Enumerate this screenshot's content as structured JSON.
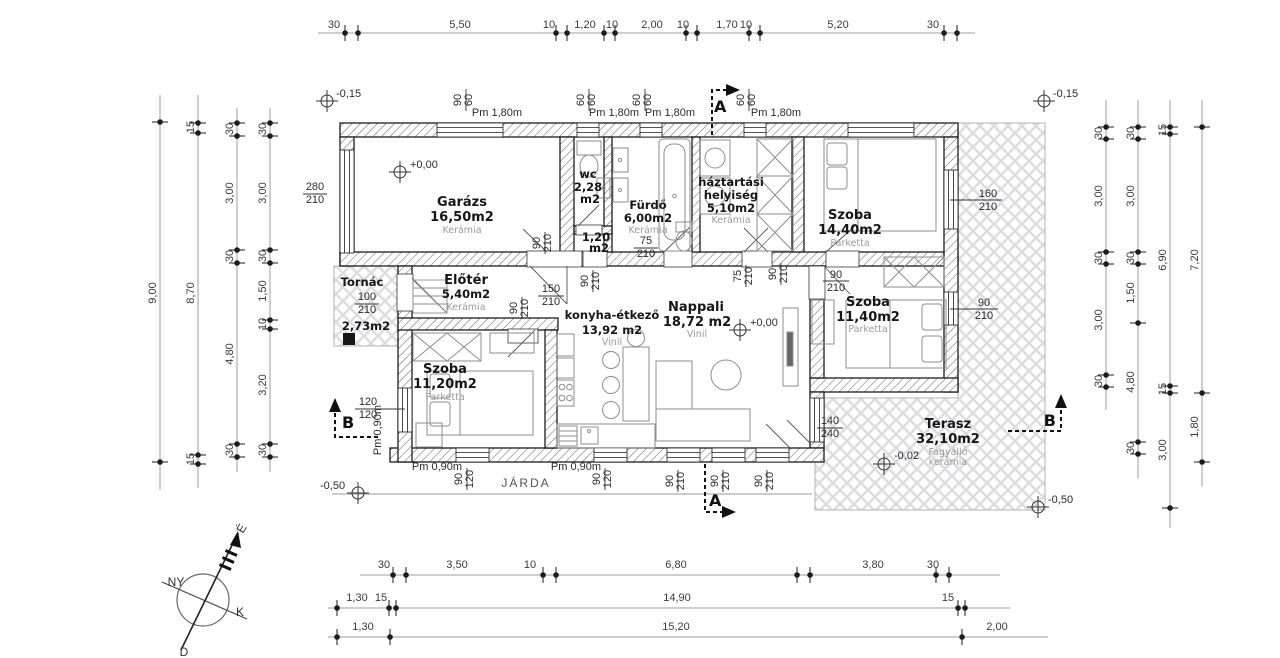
{
  "site": {
    "sidewalk": "JÁRDA"
  },
  "compass": {
    "n": "É",
    "w": "NY",
    "e": "K",
    "s": "D"
  },
  "sections": {
    "a": "A",
    "b": "B"
  },
  "elevations": {
    "top_left": "-0,15",
    "top_right": "-0,15",
    "garage": "+0,00",
    "living": "+0,00",
    "terrace": "-0,02",
    "street_left": "-0,50",
    "street_right": "-0,50"
  },
  "rooms": {
    "garazs": {
      "name": "Garázs",
      "area": "16,50m2",
      "floor": "Kerámia"
    },
    "wc": {
      "name": "wc",
      "area": "2,28",
      "unit": "m2"
    },
    "kozlekedo": {
      "area": "1,20",
      "unit": "m2"
    },
    "furdo": {
      "name": "Fürdő",
      "area": "6,00m2",
      "floor": "Kerámia"
    },
    "haztartasi": {
      "name_line1": "háztartási",
      "name_line2": "helyiség",
      "area": "5,10m2",
      "floor": "Kerámia"
    },
    "szoba_nagy": {
      "name": "Szoba",
      "area": "14,40m2",
      "floor": "Parketta"
    },
    "tornac": {
      "name": "Tornác",
      "area": "2,73m2"
    },
    "eloter": {
      "name": "Előtér",
      "area": "5,40m2",
      "floor": "Kerámia"
    },
    "konyha": {
      "name": "konyha-étkező",
      "area": "13,92 m2",
      "floor": "Vinil"
    },
    "nappali": {
      "name": "Nappali",
      "area": "18,72 m2",
      "floor": "Vinil"
    },
    "szoba_kozepso": {
      "name": "Szoba",
      "area": "11,40m2",
      "floor": "Parketta"
    },
    "szoba_also": {
      "name": "Szoba",
      "area": "11,20m2",
      "floor": "Parketta"
    },
    "terasz": {
      "name": "Terasz",
      "area": "32,10m2",
      "floor_line1": "Fagyálló",
      "floor_line2": "kerámia"
    }
  },
  "openings": {
    "pm180": "Pm 1,80m",
    "pm090": "Pm 0,90m",
    "w9060": {
      "w": "90",
      "h": "60"
    },
    "w6060": {
      "w": "60",
      "h": "60"
    },
    "garage_door": {
      "w": "280",
      "h": "210"
    },
    "entry_door": {
      "w": "150",
      "h": "210"
    },
    "tornac_door": {
      "w": "100",
      "h": "210"
    },
    "bath_door": {
      "w": "75",
      "h": "210"
    },
    "door90": {
      "w": "90",
      "h": "210"
    },
    "window160": {
      "w": "160",
      "h": "210"
    },
    "window120": {
      "w": "120",
      "h": "120"
    },
    "window90120": {
      "w": "90",
      "h": "120"
    },
    "terrace_door": {
      "w": "140",
      "h": "240"
    }
  },
  "dims": {
    "top": [
      "30",
      "5,50",
      "10",
      "1,20",
      "10",
      "2,00",
      "10",
      "1,70",
      "10",
      "5,20",
      "30"
    ],
    "left_total": "9,00",
    "left_col2": [
      "15",
      "8,70",
      "15"
    ],
    "left_col3": [
      "30",
      "3,00",
      "30",
      "4,80",
      "30"
    ],
    "left_col4": [
      "30",
      "3,00",
      "30",
      "1,50",
      "10",
      "3,20",
      "30"
    ],
    "right_col1": [
      "30",
      "3,00",
      "30",
      "3,00",
      "30"
    ],
    "right_col2": [
      "30",
      "3,00",
      "30",
      "1,50",
      "4,80",
      "30"
    ],
    "right_col3": [
      "15",
      "6,90",
      "15",
      "3,00"
    ],
    "right_col4": [
      "7,20",
      "1,80"
    ],
    "bottom_row1": [
      "30",
      "3,50",
      "10",
      "6,80",
      "3,80",
      "30"
    ],
    "bottom_row2": [
      "1,30",
      "15",
      "14,90",
      "15"
    ],
    "bottom_row3": [
      "1,30",
      "15,20",
      "2,00"
    ]
  }
}
